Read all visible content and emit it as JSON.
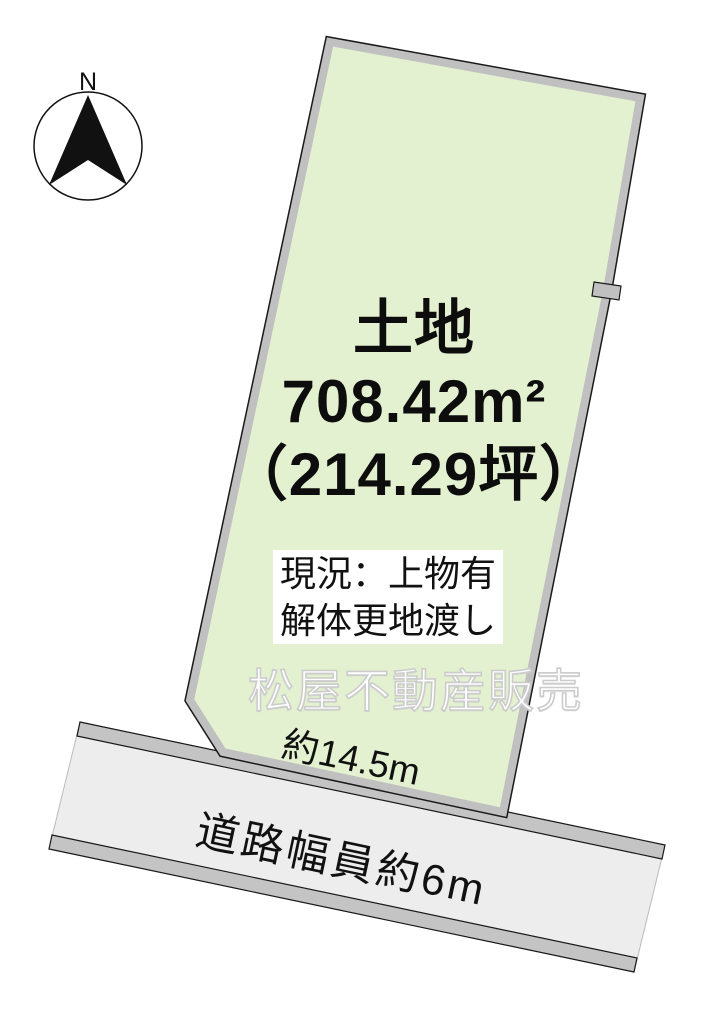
{
  "diagram": {
    "compass": {
      "north_label": "N"
    },
    "parcel": {
      "title": "土地",
      "area_sqm": "708.42m²",
      "area_tsubo": "（214.29坪）",
      "status_line1": "現況：上物有",
      "status_line2": "解体更地渡し",
      "frontage_label": "約14.5m",
      "fill_color": "#e3f1d0",
      "border_color": "#c0c0c0"
    },
    "road": {
      "label": "道路幅員約6m",
      "fill_color": "#ededed",
      "border_color": "#c4c4c4"
    },
    "watermark": {
      "text": "松屋不動産販売"
    }
  }
}
